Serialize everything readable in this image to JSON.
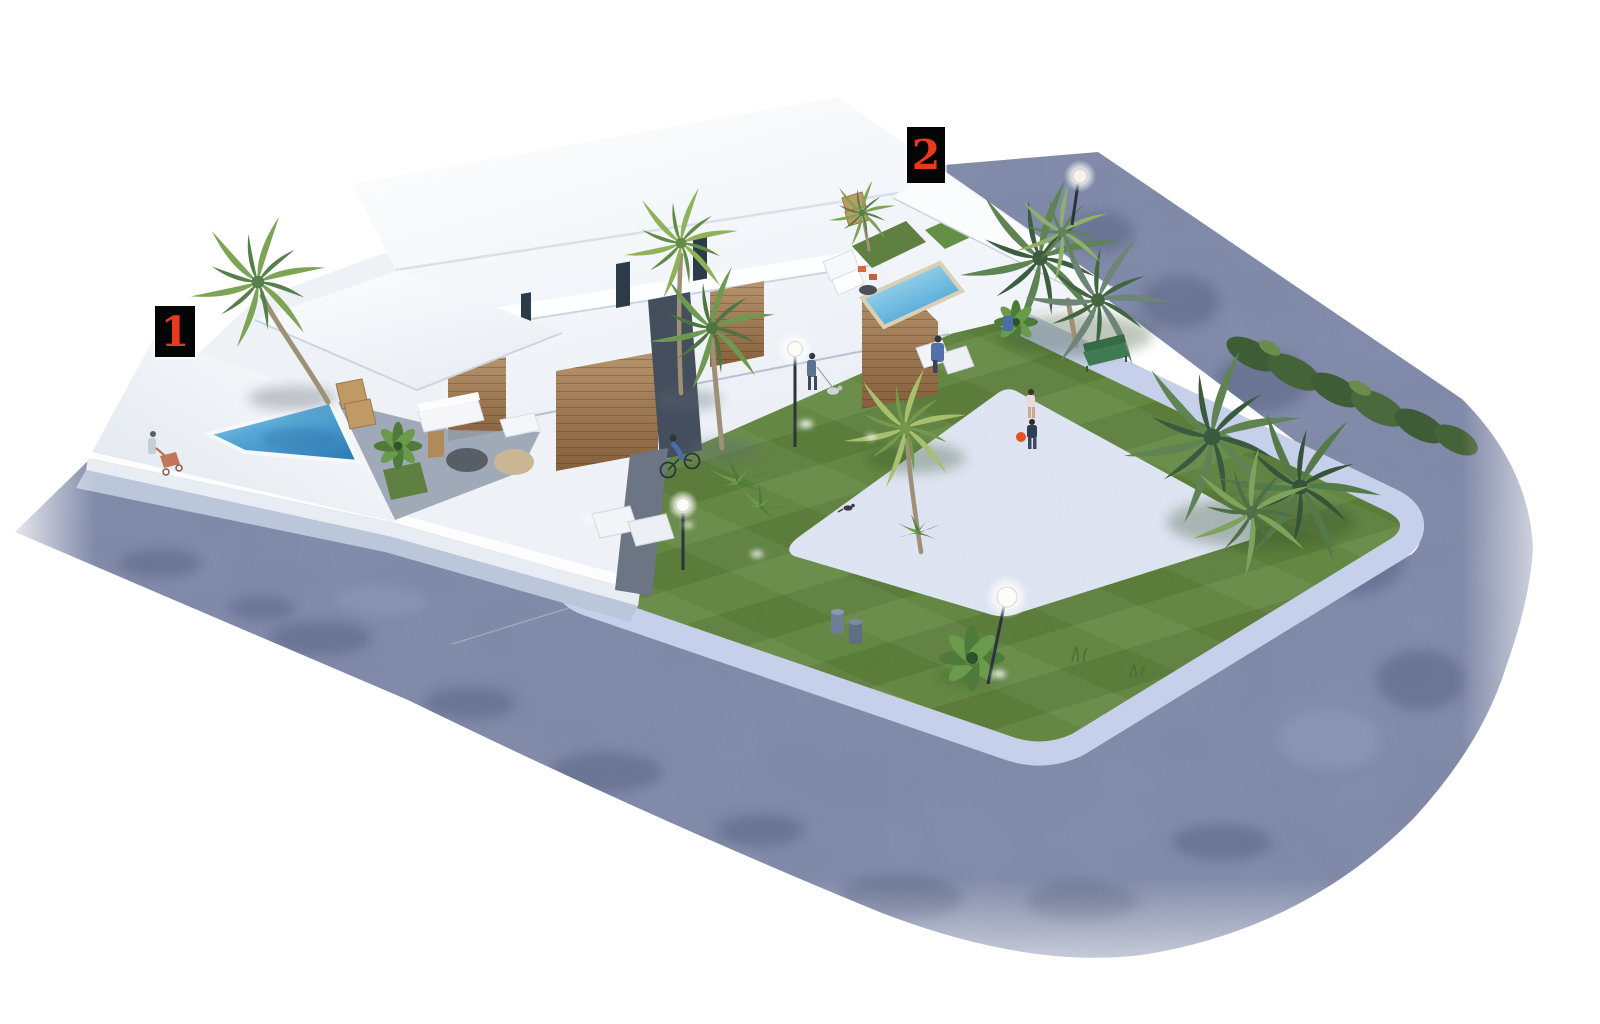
{
  "scene": {
    "description": "Aerial 3D architectural render of two white modern villas with private pools beside a landscaped corner park with palm trees, gravel plaza, benches, street lamps and people",
    "markers": [
      {
        "label": "1"
      },
      {
        "label": "2"
      }
    ]
  },
  "palette": {
    "background": "#ffffff",
    "street": "#7e88a7",
    "street_shadow": "#4d5878",
    "sidewalk": "#c6d0ea",
    "lawn": "#5b7c3a",
    "lawn_stripe": "#648843",
    "gravel": "#e0e6f3",
    "pool_water": "#3f8fc4",
    "wood_facade": "#a6805a",
    "building_white": "#f4f7fb",
    "palm_green": "#5f8a46",
    "hedge_green": "#3e5c35",
    "bench_green": "#3f7a52",
    "marker_background": "#050505",
    "marker_number_red": "#e8391d",
    "lamp_glow": "#ffffff"
  }
}
